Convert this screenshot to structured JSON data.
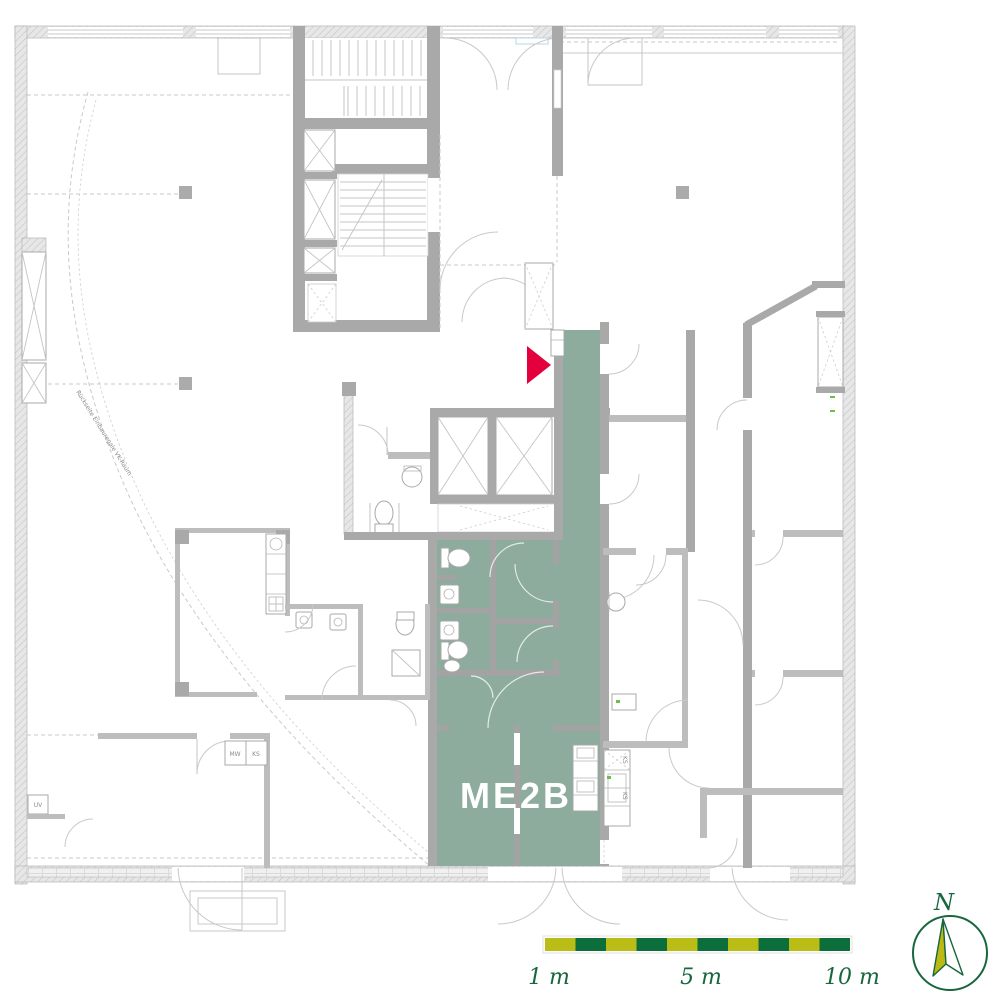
{
  "plan": {
    "unit": {
      "label": "ME2B"
    },
    "entrance_marker": {
      "icon": "entrance-arrow-icon",
      "direction": "right"
    },
    "labels": {
      "mw": "MW",
      "ks": "KS",
      "uv": "UV",
      "ks_kitchen_1": "KS",
      "ks_kitchen_2": "KS",
      "site_note": "Rückseite Einbauregale VK-Raum"
    }
  },
  "scale_bar": {
    "segments": 10,
    "segment_meters": 1,
    "labels": [
      "1 m",
      "5 m",
      "10 m"
    ]
  },
  "compass": {
    "north_label": "N"
  },
  "colors": {
    "unit_green": "#8dac9e",
    "marker_red": "#e4003c",
    "bar_yellow": "#b9bd16",
    "bar_green": "#0c6e3b",
    "compass_green": "#17663d",
    "needle_yellow": "#bdb913",
    "wall_gray": "#a9a9a9",
    "wall_light": "#bdbdbd",
    "line_gray": "#c6c6c6",
    "text_gray": "#8a8a8a"
  }
}
